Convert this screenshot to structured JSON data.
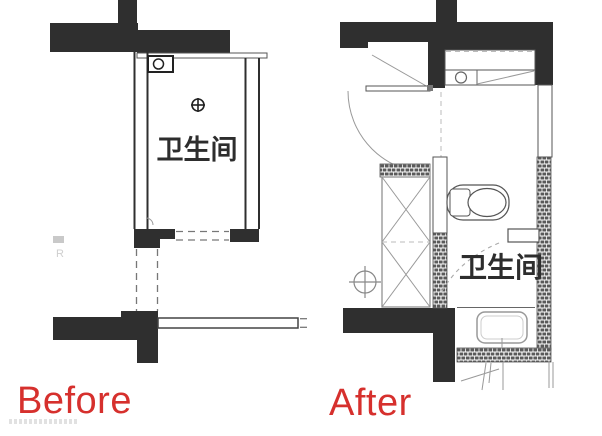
{
  "page": {
    "title": "bathroom-floor-plan-before-after",
    "background": "#ffffff"
  },
  "colors": {
    "wall": "#2f2f2f",
    "thin_line": "#999999",
    "medium_line": "#666666",
    "hatch_brick": "#5a5a5a",
    "room_label_text": "#2d2d2d",
    "caption_accent": "#d6302d",
    "watermark": "#cfcfcf"
  },
  "before": {
    "caption": "Before",
    "room_label": "卫生间",
    "watermark_letter": "R",
    "fixtures": [
      "water-heater-box",
      "floor-drain",
      "door-opening-dashed",
      "beam-outline"
    ]
  },
  "after": {
    "caption": "After",
    "room_label": "卫生间",
    "fixtures": [
      "entry-door-swing",
      "storage-cabinet",
      "washing-machine",
      "counter-diagonal",
      "shower-cabinet",
      "toilet",
      "floor-drain",
      "wash-basin",
      "bathroom-door-swing",
      "masonry-hatch-walls",
      "pipe-sketch"
    ]
  }
}
